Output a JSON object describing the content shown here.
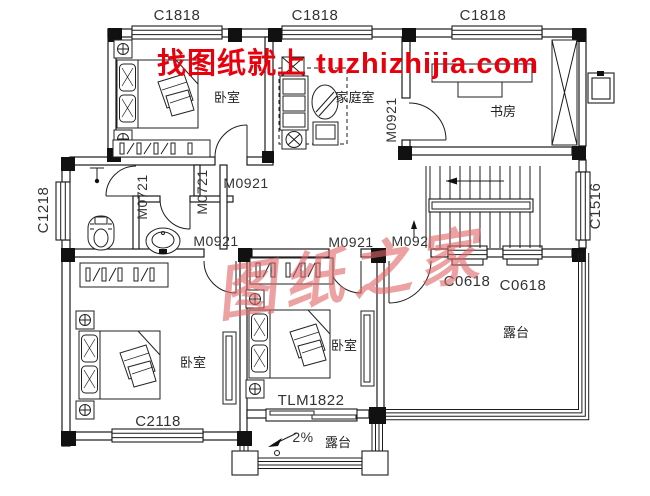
{
  "watermarks": {
    "banner": "找图纸就上 tuzhizhijia.com",
    "stamp": "图纸之家"
  },
  "rooms": {
    "bedroom": "卧室",
    "family_room": "家庭室",
    "study": "书房",
    "terrace": "露台"
  },
  "windows": {
    "c1818": "C1818",
    "c1218": "C1218",
    "c1516": "C1516",
    "c0618": "C0618",
    "c2118": "C2118"
  },
  "doors": {
    "m0721": "M0721",
    "m0921": "M0921",
    "m092": "M092",
    "tlm1822": "TLM1822"
  },
  "annotations": {
    "slope": "2%"
  },
  "colors": {
    "line": "#1c1c1c",
    "label": "#333333",
    "watermark_red": "#e8000d",
    "stamp_red": "#e06666"
  }
}
